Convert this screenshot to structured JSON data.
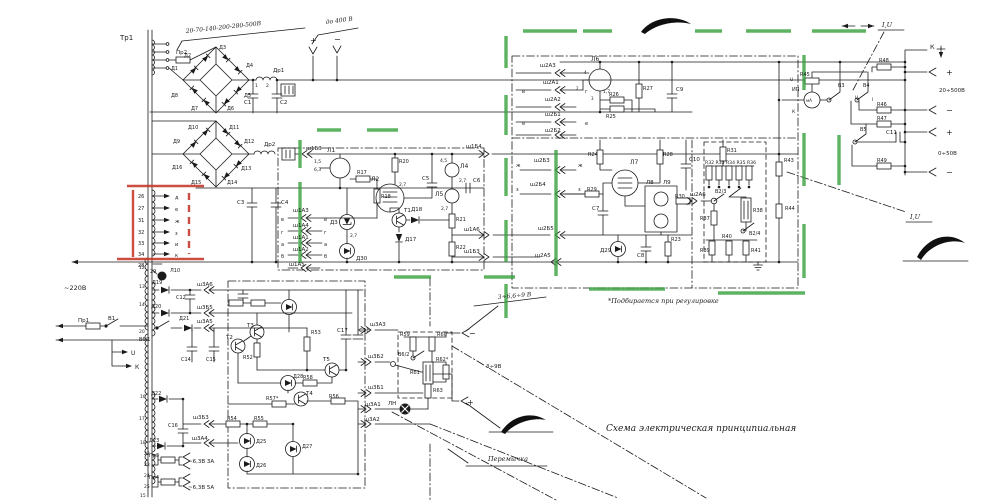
{
  "meta": {
    "title": "Схема электрическая принципиальная",
    "note": "*Подбирается при регулировке",
    "jumper_label": "Перемычка",
    "mains_label": "~220В",
    "output_ranges": [
      "до 400 В",
      "20÷500В",
      "0÷50В",
      "3÷6,6÷9 В",
      "3÷9В",
      "~6,3В 3А",
      "~6,3В 5А"
    ]
  },
  "highlights": {
    "marker_green": "#35a03a",
    "marker_red": "#c83a2c",
    "ink": "#1b1b1b"
  },
  "labels": [
    {
      "t": "Тр1",
      "x": 120,
      "y": 40,
      "s": 7
    },
    {
      "t": "20-70-140-200-280-500В",
      "x": 186,
      "y": 33,
      "s": 6,
      "h": 1,
      "r": -6
    },
    {
      "t": "Пр2",
      "x": 176,
      "y": 54,
      "s": 5.5
    },
    {
      "t": "Д1",
      "x": 171,
      "y": 70,
      "s": 5
    },
    {
      "t": "Д2",
      "x": 184,
      "y": 57,
      "s": 5
    },
    {
      "t": "Д3",
      "x": 219,
      "y": 49,
      "s": 5
    },
    {
      "t": "Д4",
      "x": 246,
      "y": 67,
      "s": 5
    },
    {
      "t": "Д5",
      "x": 244,
      "y": 97,
      "s": 5
    },
    {
      "t": "Д6",
      "x": 227,
      "y": 110,
      "s": 5
    },
    {
      "t": "Д7",
      "x": 191,
      "y": 110,
      "s": 5
    },
    {
      "t": "Д8",
      "x": 171,
      "y": 97,
      "s": 5
    },
    {
      "t": "Др1",
      "x": 273,
      "y": 72,
      "s": 5.5
    },
    {
      "t": "1",
      "x": 255,
      "y": 87,
      "s": 4.5
    },
    {
      "t": "2",
      "x": 266,
      "y": 87,
      "s": 4.5
    },
    {
      "t": "С1",
      "x": 244,
      "y": 104,
      "s": 5.5
    },
    {
      "t": "С2",
      "x": 280,
      "y": 104,
      "s": 5.5
    },
    {
      "t": "до 400 В",
      "x": 326,
      "y": 24,
      "s": 6,
      "h": 1,
      "r": -7
    },
    {
      "t": "+",
      "x": 310,
      "y": 43,
      "s": 8
    },
    {
      "t": "−",
      "x": 334,
      "y": 42,
      "s": 8
    },
    {
      "t": "Д9",
      "x": 173,
      "y": 143,
      "s": 5
    },
    {
      "t": "Д10",
      "x": 188,
      "y": 129,
      "s": 5
    },
    {
      "t": "Д11",
      "x": 229,
      "y": 129,
      "s": 5
    },
    {
      "t": "Д12",
      "x": 244,
      "y": 143,
      "s": 5
    },
    {
      "t": "Д13",
      "x": 241,
      "y": 170,
      "s": 5
    },
    {
      "t": "Д14",
      "x": 227,
      "y": 184,
      "s": 5
    },
    {
      "t": "Д15",
      "x": 191,
      "y": 184,
      "s": 5
    },
    {
      "t": "Д16",
      "x": 172,
      "y": 169,
      "s": 5
    },
    {
      "t": "Др2",
      "x": 264,
      "y": 146,
      "s": 5.5
    },
    {
      "t": "С3",
      "x": 237,
      "y": 204,
      "s": 5.5
    },
    {
      "t": "С4",
      "x": 281,
      "y": 204,
      "s": 5.5
    },
    {
      "t": "ш1Б3",
      "x": 306,
      "y": 150,
      "s": 5.5
    },
    {
      "t": "26",
      "x": 138,
      "y": 198,
      "s": 5
    },
    {
      "t": "27",
      "x": 138,
      "y": 210,
      "s": 5
    },
    {
      "t": "31",
      "x": 138,
      "y": 222,
      "s": 5
    },
    {
      "t": "32",
      "x": 138,
      "y": 234,
      "s": 5
    },
    {
      "t": "33",
      "x": 138,
      "y": 245,
      "s": 5
    },
    {
      "t": "34",
      "x": 138,
      "y": 256,
      "s": 5
    },
    {
      "t": "д",
      "x": 175,
      "y": 199,
      "s": 5
    },
    {
      "t": "е",
      "x": 175,
      "y": 211,
      "s": 5
    },
    {
      "t": "ж",
      "x": 175,
      "y": 223,
      "s": 5
    },
    {
      "t": "з",
      "x": 175,
      "y": 235,
      "s": 5
    },
    {
      "t": "и",
      "x": 175,
      "y": 246,
      "s": 5
    },
    {
      "t": "к",
      "x": 175,
      "y": 257,
      "s": 5
    },
    {
      "t": "28",
      "x": 138,
      "y": 267,
      "s": 5
    },
    {
      "t": "29",
      "x": 150,
      "y": 273,
      "s": 5
    },
    {
      "t": "Л10",
      "x": 170,
      "y": 272,
      "s": 5
    },
    {
      "t": "~220В",
      "x": 64,
      "y": 290,
      "s": 6.5
    },
    {
      "t": "Пр1",
      "x": 78,
      "y": 322,
      "s": 5.5
    },
    {
      "t": "В1",
      "x": 108,
      "y": 320,
      "s": 5.5
    },
    {
      "t": "U",
      "x": 131,
      "y": 355,
      "s": 6
    },
    {
      "t": "К",
      "x": 135,
      "y": 369,
      "s": 6
    },
    {
      "t": "Л1",
      "x": 327,
      "y": 152,
      "s": 6
    },
    {
      "t": "1,5",
      "x": 314,
      "y": 163,
      "s": 4.5
    },
    {
      "t": "6,3",
      "x": 314,
      "y": 171,
      "s": 4.5
    },
    {
      "t": "R17",
      "x": 357,
      "y": 174,
      "s": 5
    },
    {
      "t": "R18",
      "x": 381,
      "y": 198,
      "s": 5
    },
    {
      "t": "Л2",
      "x": 371,
      "y": 181,
      "s": 6
    },
    {
      "t": "2,7",
      "x": 399,
      "y": 186,
      "s": 4.5
    },
    {
      "t": "R20",
      "x": 399,
      "y": 163,
      "s": 5
    },
    {
      "t": "С5",
      "x": 422,
      "y": 180,
      "s": 5.5
    },
    {
      "t": "Л4",
      "x": 460,
      "y": 168,
      "s": 6
    },
    {
      "t": "4,5",
      "x": 440,
      "y": 162,
      "s": 4.5
    },
    {
      "t": "2,7",
      "x": 459,
      "y": 182,
      "s": 4.5
    },
    {
      "t": "Л5",
      "x": 435,
      "y": 196,
      "s": 6
    },
    {
      "t": "2,7",
      "x": 441,
      "y": 210,
      "s": 4.5
    },
    {
      "t": "С6",
      "x": 473,
      "y": 182,
      "s": 5.5
    },
    {
      "t": "Д3",
      "x": 330,
      "y": 224,
      "s": 5.5
    },
    {
      "t": "2,7",
      "x": 350,
      "y": 237,
      "s": 4.5
    },
    {
      "t": "Д30",
      "x": 356,
      "y": 260,
      "s": 5.5
    },
    {
      "t": "Т1",
      "x": 404,
      "y": 212,
      "s": 5.5
    },
    {
      "t": "Д18",
      "x": 411,
      "y": 211,
      "s": 5.5
    },
    {
      "t": "Д17",
      "x": 405,
      "y": 241,
      "s": 5.5
    },
    {
      "t": "R21",
      "x": 456,
      "y": 221,
      "s": 5
    },
    {
      "t": "R22",
      "x": 456,
      "y": 249,
      "s": 5
    },
    {
      "t": "ш1Б4",
      "x": 466,
      "y": 148,
      "s": 5.5
    },
    {
      "t": "ш1А6",
      "x": 464,
      "y": 231,
      "s": 5.5
    },
    {
      "t": "ш1Б3",
      "x": 464,
      "y": 253,
      "s": 5.5
    },
    {
      "t": "в",
      "x": 281,
      "y": 221,
      "s": 5
    },
    {
      "t": "ш1А3",
      "x": 293,
      "y": 212,
      "s": 5.5
    },
    {
      "t": "в",
      "x": 324,
      "y": 221,
      "s": 5
    },
    {
      "t": "г",
      "x": 281,
      "y": 234,
      "s": 5
    },
    {
      "t": "ш1А4",
      "x": 293,
      "y": 227,
      "s": 5.5
    },
    {
      "t": "г",
      "x": 324,
      "y": 234,
      "s": 5
    },
    {
      "t": "а",
      "x": 281,
      "y": 246,
      "s": 5
    },
    {
      "t": "ш1А1",
      "x": 293,
      "y": 239,
      "s": 5.5
    },
    {
      "t": "а",
      "x": 324,
      "y": 246,
      "s": 5
    },
    {
      "t": "б",
      "x": 281,
      "y": 258,
      "s": 5
    },
    {
      "t": "ш1А2",
      "x": 293,
      "y": 251,
      "s": 5.5
    },
    {
      "t": "б",
      "x": 324,
      "y": 258,
      "s": 5
    },
    {
      "t": "ш1А5",
      "x": 289,
      "y": 266,
      "s": 5.5
    },
    {
      "t": "ж",
      "x": 516,
      "y": 167,
      "s": 5
    },
    {
      "t": "ш2Б3",
      "x": 534,
      "y": 162,
      "s": 5.5
    },
    {
      "t": "ж",
      "x": 578,
      "y": 167,
      "s": 5
    },
    {
      "t": "з",
      "x": 516,
      "y": 191,
      "s": 5
    },
    {
      "t": "ш2Б4",
      "x": 530,
      "y": 186,
      "s": 5.5
    },
    {
      "t": "з",
      "x": 578,
      "y": 191,
      "s": 5
    },
    {
      "t": "ш2Б5",
      "x": 538,
      "y": 230,
      "s": 5.5
    },
    {
      "t": "ш2А5",
      "x": 535,
      "y": 257,
      "s": 5.5
    },
    {
      "t": "ш2А3",
      "x": 540,
      "y": 67,
      "s": 5.5
    },
    {
      "t": "ш2А1",
      "x": 543,
      "y": 84,
      "s": 5.5
    },
    {
      "t": "в",
      "x": 522,
      "y": 93,
      "s": 5
    },
    {
      "t": "г",
      "x": 585,
      "y": 93,
      "s": 5
    },
    {
      "t": "ш2А2",
      "x": 545,
      "y": 101,
      "s": 5.5
    },
    {
      "t": "ш2Б1",
      "x": 545,
      "y": 116,
      "s": 5.5
    },
    {
      "t": "е",
      "x": 522,
      "y": 125,
      "s": 5
    },
    {
      "t": "е",
      "x": 585,
      "y": 125,
      "s": 5
    },
    {
      "t": "ш2Б2",
      "x": 545,
      "y": 132,
      "s": 5.5
    },
    {
      "t": "Л6",
      "x": 591,
      "y": 61,
      "s": 6
    },
    {
      "t": "1,7",
      "x": 603,
      "y": 93,
      "s": 4.5
    },
    {
      "t": "4",
      "x": 584,
      "y": 74,
      "s": 4
    },
    {
      "t": "3",
      "x": 591,
      "y": 100,
      "s": 4
    },
    {
      "t": "2",
      "x": 576,
      "y": 90,
      "s": 4
    },
    {
      "t": "R27",
      "x": 643,
      "y": 90,
      "s": 5
    },
    {
      "t": "R26",
      "x": 609,
      "y": 96,
      "s": 5
    },
    {
      "t": "R25",
      "x": 606,
      "y": 118,
      "s": 5
    },
    {
      "t": "С9",
      "x": 676,
      "y": 91,
      "s": 5.5
    },
    {
      "t": "С10",
      "x": 689,
      "y": 161,
      "s": 5.5
    },
    {
      "t": "R24",
      "x": 588,
      "y": 156,
      "s": 5
    },
    {
      "t": "Л7",
      "x": 630,
      "y": 164,
      "s": 6
    },
    {
      "t": "R28",
      "x": 663,
      "y": 156,
      "s": 5
    },
    {
      "t": "R29",
      "x": 587,
      "y": 191,
      "s": 5
    },
    {
      "t": "С7",
      "x": 592,
      "y": 210,
      "s": 5.5
    },
    {
      "t": "Л8",
      "x": 646,
      "y": 184,
      "s": 5.5
    },
    {
      "t": "Л9",
      "x": 663,
      "y": 184,
      "s": 5.5
    },
    {
      "t": "Д29",
      "x": 600,
      "y": 252,
      "s": 5.5
    },
    {
      "t": "С8",
      "x": 637,
      "y": 257,
      "s": 5.5
    },
    {
      "t": "R23",
      "x": 671,
      "y": 241,
      "s": 5
    },
    {
      "t": "R30",
      "x": 675,
      "y": 198,
      "s": 5
    },
    {
      "t": "ш2А6",
      "x": 690,
      "y": 196,
      "s": 5.5
    },
    {
      "t": "В2/3",
      "x": 715,
      "y": 193,
      "s": 5
    },
    {
      "t": "R37",
      "x": 700,
      "y": 220,
      "s": 5
    },
    {
      "t": "R38",
      "x": 753,
      "y": 212,
      "s": 5
    },
    {
      "t": "В2/4",
      "x": 749,
      "y": 235,
      "s": 5
    },
    {
      "t": "R31",
      "x": 727,
      "y": 152,
      "s": 5
    },
    {
      "t": "R32 R33 R34 R35 R36",
      "x": 705,
      "y": 164,
      "s": 4.6
    },
    {
      "t": "R39",
      "x": 700,
      "y": 252,
      "s": 5
    },
    {
      "t": "R40",
      "x": 722,
      "y": 238,
      "s": 5
    },
    {
      "t": "R41",
      "x": 751,
      "y": 252,
      "s": 5
    },
    {
      "t": "R43",
      "x": 784,
      "y": 162,
      "s": 5
    },
    {
      "t": "R44",
      "x": 785,
      "y": 210,
      "s": 5
    },
    {
      "t": "R45",
      "x": 800,
      "y": 76,
      "s": 5
    },
    {
      "t": "ИП",
      "x": 792,
      "y": 91,
      "s": 5
    },
    {
      "t": "мА",
      "x": 806,
      "y": 102,
      "s": 4.2
    },
    {
      "t": "U",
      "x": 790,
      "y": 81,
      "s": 4.5
    },
    {
      "t": "К",
      "x": 792,
      "y": 113,
      "s": 4.5
    },
    {
      "t": "В3",
      "x": 838,
      "y": 87,
      "s": 5
    },
    {
      "t": "В4",
      "x": 863,
      "y": 87,
      "s": 5
    },
    {
      "t": "В5",
      "x": 860,
      "y": 131,
      "s": 5
    },
    {
      "t": "R48",
      "x": 879,
      "y": 62,
      "s": 5
    },
    {
      "t": "R46",
      "x": 877,
      "y": 106,
      "s": 5
    },
    {
      "t": "R47",
      "x": 877,
      "y": 120,
      "s": 5
    },
    {
      "t": "С11",
      "x": 886,
      "y": 134,
      "s": 5.5
    },
    {
      "t": "R49",
      "x": 877,
      "y": 162,
      "s": 5
    },
    {
      "t": "I,U",
      "x": 882,
      "y": 27,
      "s": 6.5,
      "h": 1
    },
    {
      "t": "I,U",
      "x": 910,
      "y": 219,
      "s": 6.5,
      "h": 1
    },
    {
      "t": "U",
      "x": 855,
      "y": 99,
      "s": 4.5
    },
    {
      "t": "I",
      "x": 872,
      "y": 101,
      "s": 4.5
    },
    {
      "t": "К",
      "x": 930,
      "y": 49,
      "s": 6.5
    },
    {
      "t": "+",
      "x": 946,
      "y": 75,
      "s": 8
    },
    {
      "t": "20÷500В",
      "x": 939,
      "y": 92,
      "s": 5.5
    },
    {
      "t": "−",
      "x": 946,
      "y": 113,
      "s": 8
    },
    {
      "t": "+",
      "x": 946,
      "y": 135,
      "s": 8
    },
    {
      "t": "0÷50В",
      "x": 938,
      "y": 155,
      "s": 5.5
    },
    {
      "t": "−",
      "x": 946,
      "y": 175,
      "s": 8
    },
    {
      "t": "Д19",
      "x": 152,
      "y": 284,
      "s": 5
    },
    {
      "t": "Д20",
      "x": 151,
      "y": 308,
      "s": 5
    },
    {
      "t": "Д21",
      "x": 179,
      "y": 320,
      "s": 5
    },
    {
      "t": "С12",
      "x": 176,
      "y": 299,
      "s": 5
    },
    {
      "t": "ш3А6",
      "x": 197,
      "y": 286,
      "s": 5.5
    },
    {
      "t": "ш3Б5",
      "x": 197,
      "y": 309,
      "s": 5.5
    },
    {
      "t": "ш3А5",
      "x": 197,
      "y": 323,
      "s": 5.5
    },
    {
      "t": "В6/1",
      "x": 139,
      "y": 341,
      "s": 5
    },
    {
      "t": "С14",
      "x": 181,
      "y": 361,
      "s": 5
    },
    {
      "t": "С15",
      "x": 206,
      "y": 361,
      "s": 5
    },
    {
      "t": "Т2",
      "x": 226,
      "y": 339,
      "s": 5.5
    },
    {
      "t": "Т3",
      "x": 247,
      "y": 327,
      "s": 5.5
    },
    {
      "t": "R52",
      "x": 243,
      "y": 359,
      "s": 5
    },
    {
      "t": "R53",
      "x": 311,
      "y": 334,
      "s": 5
    },
    {
      "t": "Т5",
      "x": 323,
      "y": 361,
      "s": 5.5
    },
    {
      "t": "Д28",
      "x": 293,
      "y": 378,
      "s": 5
    },
    {
      "t": "R58",
      "x": 303,
      "y": 379,
      "s": 5
    },
    {
      "t": "Т4",
      "x": 306,
      "y": 395,
      "s": 5.5
    },
    {
      "t": "R57*",
      "x": 266,
      "y": 400,
      "s": 5
    },
    {
      "t": "R56",
      "x": 329,
      "y": 398,
      "s": 5
    },
    {
      "t": "С17",
      "x": 337,
      "y": 332,
      "s": 5.5
    },
    {
      "t": "С18",
      "x": 359,
      "y": 332,
      "s": 5.5
    },
    {
      "t": "R54",
      "x": 227,
      "y": 420,
      "s": 5
    },
    {
      "t": "R55",
      "x": 254,
      "y": 420,
      "s": 5
    },
    {
      "t": "Д25",
      "x": 256,
      "y": 443,
      "s": 5
    },
    {
      "t": "Д26",
      "x": 256,
      "y": 467,
      "s": 5
    },
    {
      "t": "Д27",
      "x": 302,
      "y": 448,
      "s": 5
    },
    {
      "t": "Д22",
      "x": 151,
      "y": 395,
      "s": 5
    },
    {
      "t": "Д23",
      "x": 149,
      "y": 442,
      "s": 5
    },
    {
      "t": "С16",
      "x": 168,
      "y": 427,
      "s": 5
    },
    {
      "t": "ш3Б3",
      "x": 193,
      "y": 419,
      "s": 5.5
    },
    {
      "t": "ш3А4",
      "x": 192,
      "y": 440,
      "s": 5.5
    },
    {
      "t": "Пр3",
      "x": 149,
      "y": 457,
      "s": 5
    },
    {
      "t": "~6,3В 3А",
      "x": 188,
      "y": 463,
      "s": 5.5
    },
    {
      "t": "Пр4",
      "x": 149,
      "y": 479,
      "s": 5
    },
    {
      "t": "~6,3В 5А",
      "x": 188,
      "y": 489,
      "s": 5.5
    },
    {
      "t": "12",
      "x": 139,
      "y": 269,
      "s": 4.5
    },
    {
      "t": "13",
      "x": 139,
      "y": 288,
      "s": 4.5
    },
    {
      "t": "14",
      "x": 139,
      "y": 306,
      "s": 4.5
    },
    {
      "t": "20",
      "x": 139,
      "y": 333,
      "s": 4.5
    },
    {
      "t": "16",
      "x": 140,
      "y": 398,
      "s": 4.5
    },
    {
      "t": "17",
      "x": 139,
      "y": 420,
      "s": 4.5
    },
    {
      "t": "18",
      "x": 140,
      "y": 444,
      "s": 4.5
    },
    {
      "t": "22",
      "x": 144,
      "y": 455,
      "s": 4.5
    },
    {
      "t": "23",
      "x": 144,
      "y": 466,
      "s": 4.5
    },
    {
      "t": "24",
      "x": 144,
      "y": 477,
      "s": 4.5
    },
    {
      "t": "25",
      "x": 144,
      "y": 488,
      "s": 4.5
    },
    {
      "t": "15",
      "x": 140,
      "y": 497,
      "s": 4.5
    },
    {
      "t": "ш3А3",
      "x": 370,
      "y": 326,
      "s": 5.5
    },
    {
      "t": "ш3Б2",
      "x": 368,
      "y": 358,
      "s": 5.5
    },
    {
      "t": "ш3Б1",
      "x": 368,
      "y": 389,
      "s": 5.5
    },
    {
      "t": "ш3А1",
      "x": 365,
      "y": 406,
      "s": 5.5
    },
    {
      "t": "ш3А2",
      "x": 364,
      "y": 421,
      "s": 5.5
    },
    {
      "t": "R59",
      "x": 400,
      "y": 336,
      "s": 5
    },
    {
      "t": "R60",
      "x": 437,
      "y": 336,
      "s": 5
    },
    {
      "t": "В6/2",
      "x": 398,
      "y": 356,
      "s": 5
    },
    {
      "t": "R61",
      "x": 410,
      "y": 374,
      "s": 5
    },
    {
      "t": "R62*",
      "x": 436,
      "y": 361,
      "s": 5
    },
    {
      "t": "R63",
      "x": 433,
      "y": 392,
      "s": 5
    },
    {
      "t": "ЛН",
      "x": 388,
      "y": 405,
      "s": 5.5
    },
    {
      "t": "−",
      "x": 469,
      "y": 336,
      "s": 8
    },
    {
      "t": "+",
      "x": 467,
      "y": 405,
      "s": 8
    },
    {
      "t": "3÷6,6÷9 В",
      "x": 498,
      "y": 299,
      "s": 6,
      "h": 1,
      "r": -5
    },
    {
      "t": "3÷9В",
      "x": 486,
      "y": 368,
      "s": 5.5
    },
    {
      "t": "*Подбирается при регулировке",
      "x": 608,
      "y": 303,
      "s": 6.5,
      "h": 1
    },
    {
      "t": "Схема электрическая принципиальная",
      "x": 606,
      "y": 431,
      "s": 9,
      "h": 1
    },
    {
      "t": "Перемычка",
      "x": 488,
      "y": 461,
      "s": 6.5,
      "h": 1
    }
  ]
}
